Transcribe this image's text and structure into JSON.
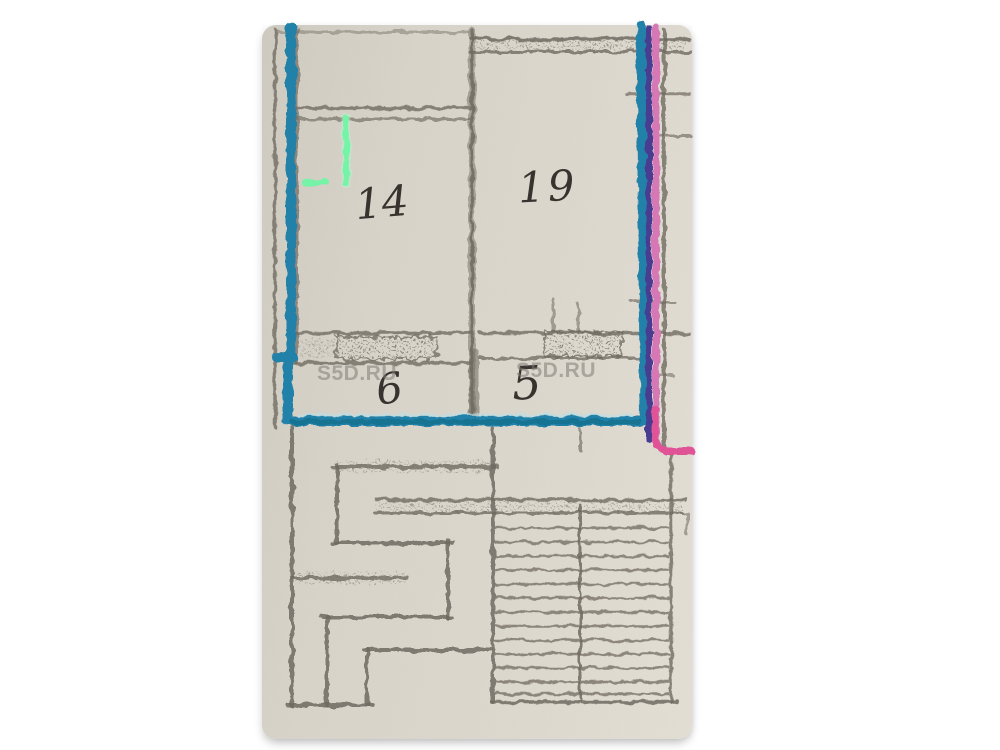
{
  "rooms": [
    {
      "label": "14"
    },
    {
      "label": "19"
    },
    {
      "label": "6"
    },
    {
      "label": "5"
    }
  ],
  "watermarks": [
    {
      "text": "S5D.RU"
    },
    {
      "text": "S5D.RU"
    }
  ],
  "colors": {
    "background": "#ffffff",
    "paper": "#d8d4ca",
    "pencil": "#6f6a60",
    "ink": "#37332f",
    "teal_marker": "#2381a8",
    "teal_marker_dark": "#15718f",
    "teal_marker_light": "#bfdde2",
    "purple_marker": "#4a3d92",
    "pink_marker": "#d678b5",
    "pink_marker_bright": "#e14f93",
    "green_marker": "#74f3a6",
    "green_marker_pale": "#b8f7d0",
    "watermark": "#7d7b77"
  }
}
